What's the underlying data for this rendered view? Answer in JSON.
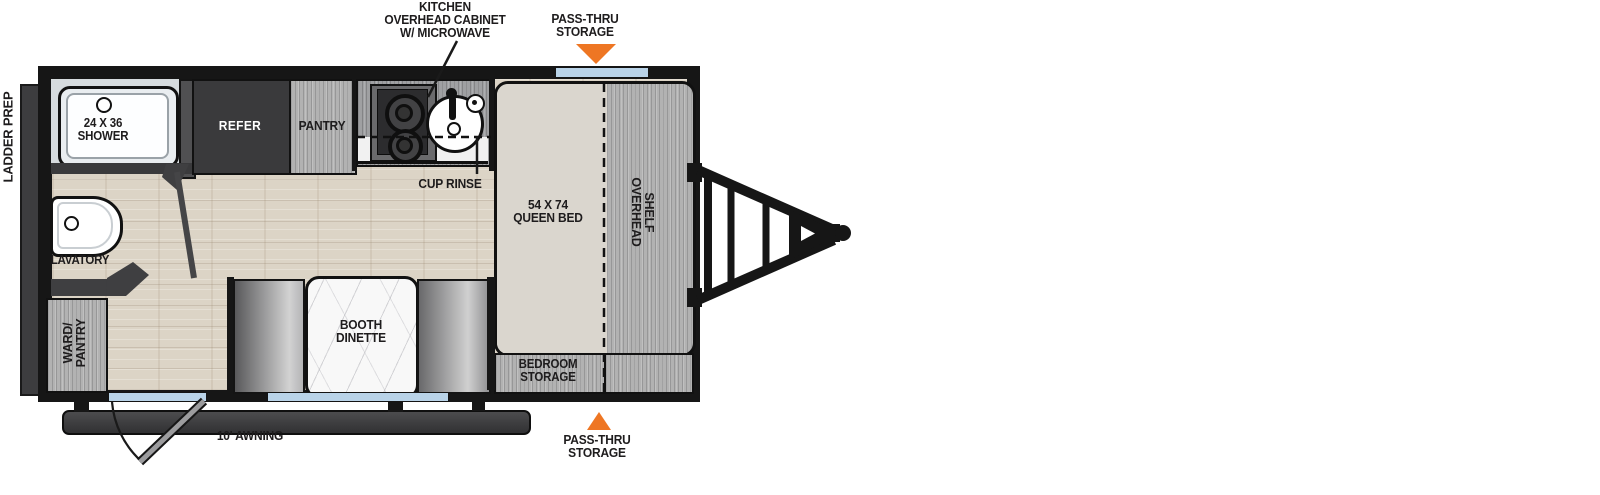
{
  "labels": {
    "ladder_prep": "LADDER PREP",
    "kitchen_callout": {
      "l1": "KITCHEN",
      "l2": "OVERHEAD CABINET",
      "l3": "W/ MICROWAVE"
    },
    "pass_thru_top": {
      "l1": "PASS-THRU",
      "l2": "STORAGE"
    },
    "pass_thru_bottom": {
      "l1": "PASS-THRU",
      "l2": "STORAGE"
    },
    "awning": "10' AWNING"
  },
  "rooms": {
    "shower": {
      "l1": "24 X 36",
      "l2": "SHOWER"
    },
    "refer": "REFER",
    "pantry": "PANTRY",
    "cup_rinse": "CUP RINSE",
    "queen_bed": {
      "l1": "54 X 74",
      "l2": "QUEEN BED"
    },
    "overhead_shelf": {
      "l1": "OVERHEAD",
      "l2": "SHELF"
    },
    "lavatory": "LAVATORY",
    "ward_pantry": {
      "l1": "WARD/",
      "l2": "PANTRY"
    },
    "booth_dinette": {
      "l1": "BOOTH",
      "l2": "DINETTE"
    },
    "bedroom_storage": {
      "l1": "BEDROOM",
      "l2": "STORAGE"
    }
  },
  "colors": {
    "accent_orange": "#ee7623",
    "window_blue": "#b9d3e8",
    "wall_black": "#161616",
    "floor_wood": "#dcd4c6",
    "cabinet_gray": "#b2b2b2",
    "appliance_dark": "#3a3a3c",
    "mattress_beige": "#dad6ce"
  }
}
